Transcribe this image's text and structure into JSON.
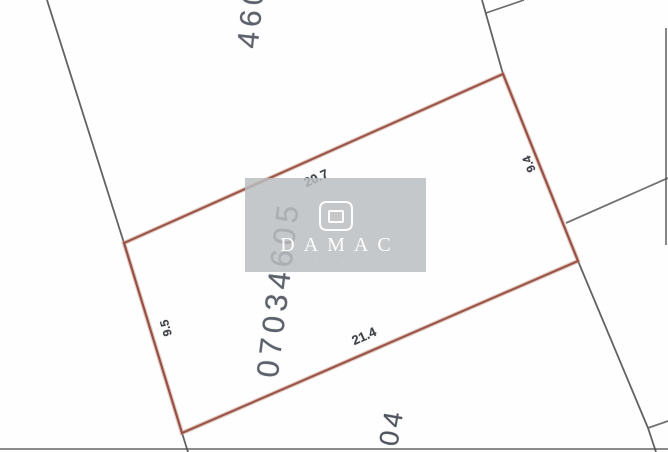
{
  "map": {
    "parcel": {
      "plot_number": "07034605",
      "dimensions": {
        "top": "20.7",
        "bottom": "21.4",
        "left": "9.5",
        "right": "9.4"
      }
    },
    "neighbor_plots": {
      "top": "460",
      "bottom": "04"
    },
    "colors": {
      "parcel_outline": "#984e40",
      "parcel_outline_halo": "#c4968a",
      "boundary_line": "#565659",
      "dimension_label": "#3d4046",
      "plot_number_label": "#5d616b",
      "watermark_gray": "#babdc0"
    }
  },
  "watermark": {
    "brand": "DAMAC",
    "subtext": "· · ·   · · · ·"
  }
}
